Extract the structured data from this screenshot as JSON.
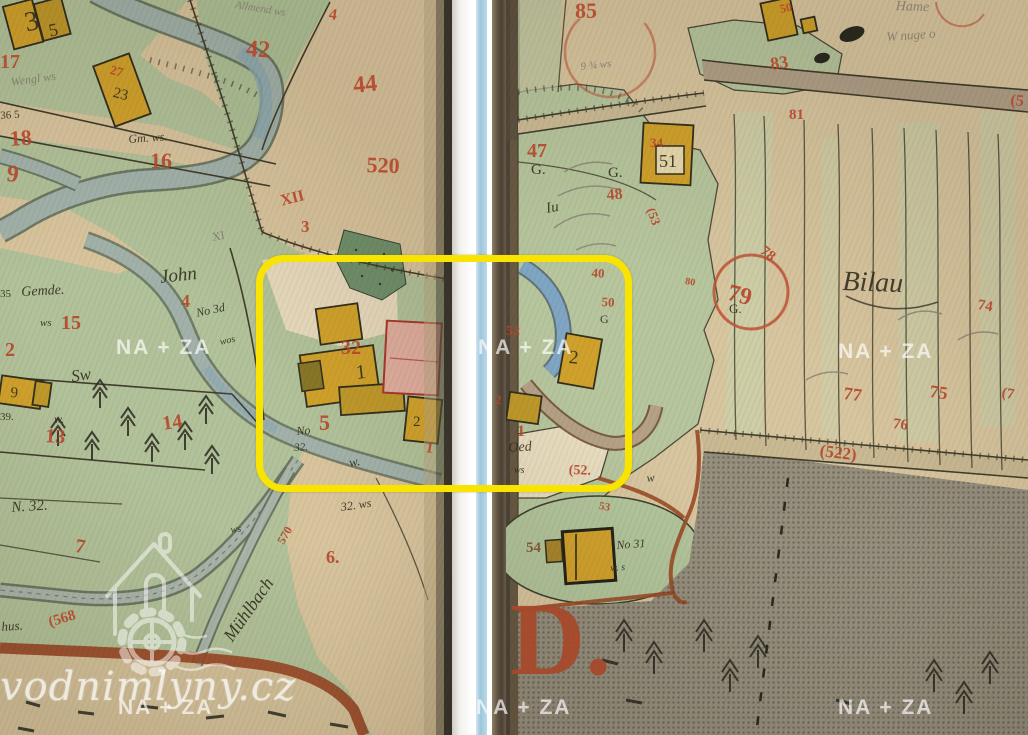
{
  "document": {
    "kind": "scanned historical cadastral map, two book pages with center binding gap",
    "place_names": [
      "John",
      "Bilau",
      "Mühlbach",
      "Allmend",
      "Oed",
      "Gemde.",
      "Hame"
    ],
    "big_letter": "D."
  },
  "annotation": {
    "highlight_color": "#f8e400"
  },
  "watermarks": {
    "na_za": "NA + ZA",
    "site": "vodnimlyny.cz"
  },
  "colors": {
    "left_page_green": "#b2c29a",
    "right_page_tan": "#d8c6a0",
    "parcel_tan": "#d8c59e",
    "stream_grey_blue": "#a2b2ab",
    "stream_blue": "#7fa6c4",
    "building_yellow": "#d0a22c",
    "building_pink": "#dfae9f",
    "road_brown": "#9a4b28",
    "grey_area": "#97907f",
    "red_ink": "#b5452b",
    "black_ink": "#2f2b1d",
    "spine_blue_line": "#9cc6dc"
  },
  "map_labels": [
    {
      "t": "3",
      "x": 22,
      "y": 10,
      "s": 28,
      "r": -12,
      "c": "ink"
    },
    {
      "t": "5",
      "x": 47,
      "y": 22,
      "s": 18,
      "r": -12,
      "c": "ink"
    },
    {
      "t": "17",
      "x": 0,
      "y": 52,
      "s": 20,
      "r": 0,
      "c": "red"
    },
    {
      "t": "Wengl ws",
      "x": 10,
      "y": 76,
      "s": 12,
      "r": -8,
      "c": "pen",
      "i": 1
    },
    {
      "t": "36 5",
      "x": 0,
      "y": 111,
      "s": 11,
      "r": -4,
      "c": "ink"
    },
    {
      "t": "18",
      "x": 9,
      "y": 128,
      "s": 22,
      "r": -4,
      "c": "red"
    },
    {
      "t": "9",
      "x": 8,
      "y": 162,
      "s": 24,
      "r": 6,
      "c": "red"
    },
    {
      "t": "27",
      "x": 112,
      "y": 63,
      "s": 13,
      "r": 14,
      "c": "red"
    },
    {
      "t": "23",
      "x": 115,
      "y": 86,
      "s": 15,
      "r": 14,
      "c": "ink"
    },
    {
      "t": "Gm. ws.",
      "x": 128,
      "y": 133,
      "s": 12,
      "r": -4,
      "c": "ink",
      "i": 1
    },
    {
      "t": "16",
      "x": 150,
      "y": 150,
      "s": 22,
      "r": 0,
      "c": "red"
    },
    {
      "t": "Allmend ws",
      "x": 236,
      "y": 0,
      "s": 11,
      "r": 9,
      "c": "pen",
      "i": 1
    },
    {
      "t": "4",
      "x": 330,
      "y": 7,
      "s": 16,
      "r": 8,
      "c": "red"
    },
    {
      "t": "42",
      "x": 247,
      "y": 37,
      "s": 24,
      "r": 4,
      "c": "red"
    },
    {
      "t": "44",
      "x": 352,
      "y": 74,
      "s": 24,
      "r": -6,
      "c": "red"
    },
    {
      "t": "520",
      "x": 367,
      "y": 154,
      "s": 22,
      "r": 2,
      "c": "red"
    },
    {
      "t": "XII",
      "x": 279,
      "y": 194,
      "s": 16,
      "r": -14,
      "c": "red"
    },
    {
      "t": "3",
      "x": 301,
      "y": 218,
      "s": 17,
      "r": 0,
      "c": "red"
    },
    {
      "t": "XI",
      "x": 211,
      "y": 231,
      "s": 12,
      "r": -10,
      "c": "pen"
    },
    {
      "t": "John",
      "x": 159,
      "y": 268,
      "s": 19,
      "r": -6,
      "c": "ink",
      "i": 1
    },
    {
      "t": "4",
      "x": 181,
      "y": 292,
      "s": 18,
      "r": 0,
      "c": "red"
    },
    {
      "t": "No 3d",
      "x": 195,
      "y": 307,
      "s": 12,
      "r": -12,
      "c": "ink",
      "i": 1
    },
    {
      "t": "wos",
      "x": 219,
      "y": 338,
      "s": 10,
      "r": -12,
      "c": "ink",
      "i": 1
    },
    {
      "t": "35",
      "x": 0,
      "y": 289,
      "s": 11,
      "r": 0,
      "c": "ink"
    },
    {
      "t": "Gemde.",
      "x": 21,
      "y": 286,
      "s": 14,
      "r": -3,
      "c": "ink",
      "i": 1
    },
    {
      "t": "ws",
      "x": 40,
      "y": 318,
      "s": 11,
      "r": 0,
      "c": "ink",
      "i": 1
    },
    {
      "t": "15",
      "x": 61,
      "y": 313,
      "s": 20,
      "r": 0,
      "c": "red"
    },
    {
      "t": "2",
      "x": 5,
      "y": 340,
      "s": 20,
      "r": 0,
      "c": "red"
    },
    {
      "t": "Sw",
      "x": 70,
      "y": 368,
      "s": 17,
      "r": -8,
      "c": "ink",
      "i": 1
    },
    {
      "t": "9",
      "x": 11,
      "y": 386,
      "s": 15,
      "r": 4,
      "c": "ink"
    },
    {
      "t": "39.",
      "x": 0,
      "y": 412,
      "s": 11,
      "r": 0,
      "c": "ink"
    },
    {
      "t": "w.",
      "x": 54,
      "y": 413,
      "s": 12,
      "r": 0,
      "c": "ink",
      "i": 1
    },
    {
      "t": "13",
      "x": 46,
      "y": 426,
      "s": 20,
      "r": 4,
      "c": "red"
    },
    {
      "t": "14",
      "x": 161,
      "y": 414,
      "s": 20,
      "r": -8,
      "c": "red"
    },
    {
      "t": "N. 32.",
      "x": 11,
      "y": 501,
      "s": 15,
      "r": -4,
      "c": "ink",
      "i": 1
    },
    {
      "t": "7",
      "x": 77,
      "y": 536,
      "s": 20,
      "r": 10,
      "c": "red"
    },
    {
      "t": "(568",
      "x": 47,
      "y": 616,
      "s": 15,
      "r": -16,
      "c": "red"
    },
    {
      "t": "hus.",
      "x": 1,
      "y": 620,
      "s": 13,
      "r": -4,
      "c": "ink",
      "i": 1
    },
    {
      "t": "Mühlbach",
      "x": 220,
      "y": 634,
      "s": 18,
      "r": -55,
      "c": "ink",
      "i": 1
    },
    {
      "t": "570",
      "x": 275,
      "y": 540,
      "s": 12,
      "r": -60,
      "c": "red"
    },
    {
      "t": "ws",
      "x": 230,
      "y": 526,
      "s": 10,
      "r": -8,
      "c": "ink",
      "i": 1
    },
    {
      "t": "32. ws",
      "x": 340,
      "y": 501,
      "s": 12,
      "r": -8,
      "c": "ink",
      "i": 1
    },
    {
      "t": "6.",
      "x": 326,
      "y": 548,
      "s": 18,
      "r": 0,
      "c": "red"
    },
    {
      "t": "No",
      "x": 296,
      "y": 425,
      "s": 12,
      "r": -4,
      "c": "ink",
      "i": 1
    },
    {
      "t": "5",
      "x": 319,
      "y": 412,
      "s": 22,
      "r": 0,
      "c": "red"
    },
    {
      "t": "32.",
      "x": 294,
      "y": 443,
      "s": 11,
      "r": -4,
      "c": "ink",
      "i": 1
    },
    {
      "t": "32",
      "x": 341,
      "y": 338,
      "s": 20,
      "r": 0,
      "c": "red"
    },
    {
      "t": "1",
      "x": 355,
      "y": 363,
      "s": 20,
      "r": -6,
      "c": "ink"
    },
    {
      "t": "2",
      "x": 413,
      "y": 415,
      "s": 15,
      "r": 0,
      "c": "ink"
    },
    {
      "t": "1",
      "x": 427,
      "y": 441,
      "s": 15,
      "r": 10,
      "c": "red"
    },
    {
      "t": "w.",
      "x": 348,
      "y": 456,
      "s": 13,
      "r": -10,
      "c": "ink",
      "i": 1
    },
    {
      "t": "85",
      "x": 575,
      "y": 0,
      "s": 22,
      "r": 0,
      "c": "red"
    },
    {
      "t": "9 ¾ ws",
      "x": 580,
      "y": 62,
      "s": 11,
      "r": -6,
      "c": "pen",
      "i": 1
    },
    {
      "t": "Hame",
      "x": 896,
      "y": 0,
      "s": 14,
      "r": 2,
      "c": "pen",
      "i": 1
    },
    {
      "t": "W nuge o",
      "x": 886,
      "y": 30,
      "s": 13,
      "r": -4,
      "c": "pen",
      "i": 1
    },
    {
      "t": "50",
      "x": 779,
      "y": 3,
      "s": 12,
      "r": -10,
      "c": "red"
    },
    {
      "t": "83",
      "x": 769,
      "y": 55,
      "s": 18,
      "r": -8,
      "c": "red"
    },
    {
      "t": "81",
      "x": 789,
      "y": 108,
      "s": 15,
      "r": 0,
      "c": "red"
    },
    {
      "t": "(5",
      "x": 1011,
      "y": 93,
      "s": 16,
      "r": 4,
      "c": "red"
    },
    {
      "t": "47",
      "x": 527,
      "y": 141,
      "s": 20,
      "r": 0,
      "c": "red"
    },
    {
      "t": "G.",
      "x": 531,
      "y": 163,
      "s": 15,
      "r": 0,
      "c": "ink"
    },
    {
      "t": "G.",
      "x": 608,
      "y": 166,
      "s": 15,
      "r": 0,
      "c": "ink"
    },
    {
      "t": "34",
      "x": 650,
      "y": 136,
      "s": 13,
      "r": 0,
      "c": "red"
    },
    {
      "t": "51",
      "x": 659,
      "y": 152,
      "s": 18,
      "r": 0,
      "c": "ink"
    },
    {
      "t": "48",
      "x": 606,
      "y": 188,
      "s": 16,
      "r": -5,
      "c": "red"
    },
    {
      "t": "Iu",
      "x": 545,
      "y": 202,
      "s": 15,
      "r": -10,
      "c": "ink",
      "i": 1
    },
    {
      "t": "(53",
      "x": 657,
      "y": 206,
      "s": 13,
      "r": 70,
      "c": "red"
    },
    {
      "t": "40",
      "x": 592,
      "y": 266,
      "s": 13,
      "r": 4,
      "c": "red"
    },
    {
      "t": "50",
      "x": 602,
      "y": 295,
      "s": 13,
      "r": 4,
      "c": "red"
    },
    {
      "t": "G",
      "x": 600,
      "y": 313,
      "s": 12,
      "r": 0,
      "c": "ink"
    },
    {
      "t": "52",
      "x": 506,
      "y": 325,
      "s": 14,
      "r": 0,
      "c": "red"
    },
    {
      "t": "2",
      "x": 570,
      "y": 348,
      "s": 19,
      "r": 6,
      "c": "ink"
    },
    {
      "t": "2",
      "x": 495,
      "y": 393,
      "s": 13,
      "r": 0,
      "c": "red"
    },
    {
      "t": "1",
      "x": 517,
      "y": 424,
      "s": 16,
      "r": 0,
      "c": "red"
    },
    {
      "t": "Oed",
      "x": 508,
      "y": 442,
      "s": 14,
      "r": -4,
      "c": "ink",
      "i": 1
    },
    {
      "t": "ws",
      "x": 514,
      "y": 466,
      "s": 10,
      "r": 0,
      "c": "ink",
      "i": 1
    },
    {
      "t": "(52.",
      "x": 569,
      "y": 464,
      "s": 14,
      "r": 2,
      "c": "red"
    },
    {
      "t": "w",
      "x": 646,
      "y": 472,
      "s": 12,
      "r": -6,
      "c": "ink",
      "i": 1
    },
    {
      "t": "80",
      "x": 686,
      "y": 277,
      "s": 10,
      "r": 10,
      "c": "red"
    },
    {
      "t": "79",
      "x": 731,
      "y": 281,
      "s": 24,
      "r": 14,
      "c": "red"
    },
    {
      "t": "78",
      "x": 766,
      "y": 244,
      "s": 15,
      "r": 38,
      "c": "red"
    },
    {
      "t": "G.",
      "x": 729,
      "y": 302,
      "s": 13,
      "r": 0,
      "c": "ink"
    },
    {
      "t": "Bilau",
      "x": 843,
      "y": 268,
      "s": 28,
      "r": 2,
      "c": "ink",
      "i": 1
    },
    {
      "t": "74",
      "x": 979,
      "y": 298,
      "s": 15,
      "r": 10,
      "c": "red"
    },
    {
      "t": "77",
      "x": 845,
      "y": 384,
      "s": 18,
      "r": 8,
      "c": "red"
    },
    {
      "t": "75",
      "x": 931,
      "y": 382,
      "s": 18,
      "r": 8,
      "c": "red"
    },
    {
      "t": "76",
      "x": 894,
      "y": 417,
      "s": 15,
      "r": 8,
      "c": "red"
    },
    {
      "t": "(7",
      "x": 1003,
      "y": 386,
      "s": 15,
      "r": 10,
      "c": "red"
    },
    {
      "t": "(522)",
      "x": 821,
      "y": 442,
      "s": 17,
      "r": 7,
      "c": "red"
    },
    {
      "t": "53",
      "x": 600,
      "y": 501,
      "s": 11,
      "r": 10,
      "c": "red"
    },
    {
      "t": "54",
      "x": 526,
      "y": 541,
      "s": 15,
      "r": 0,
      "c": "brn"
    },
    {
      "t": "No 31",
      "x": 616,
      "y": 539,
      "s": 12,
      "r": -4,
      "c": "ink",
      "i": 1
    },
    {
      "t": "w. s",
      "x": 610,
      "y": 564,
      "s": 10,
      "r": -4,
      "c": "ink",
      "i": 1
    },
    {
      "t": "D.",
      "x": 510,
      "y": 588,
      "s": 104,
      "r": 0,
      "c": "big"
    }
  ]
}
